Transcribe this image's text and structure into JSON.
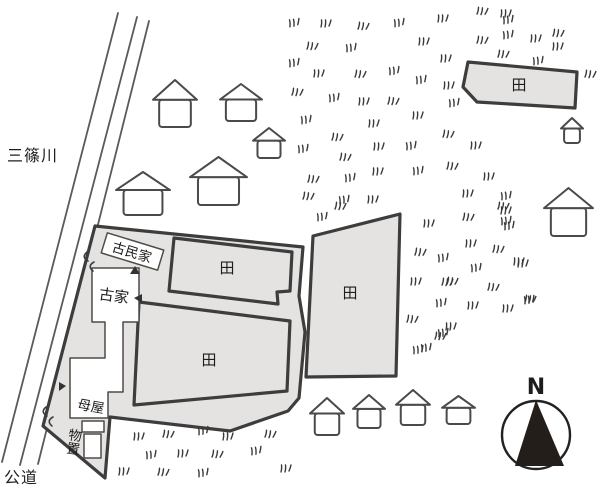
{
  "map": {
    "labels": {
      "river": "三篠川",
      "road": "公道",
      "old_folk_house": "古民家",
      "old_house": "古家",
      "main_house": "母屋",
      "storage": "物置",
      "rice_field": "田",
      "north": "N"
    },
    "colors": {
      "parcel_fill": "#e4e3e2",
      "outline": "#3d3d3d",
      "building_stroke": "#4f4b48",
      "road_line": "#5a5a5a",
      "compass_fill": "#241e1b",
      "text": "#1d1d1d"
    },
    "houses": [
      {
        "x": 153,
        "y": 80,
        "w": 44,
        "h": 47
      },
      {
        "x": 220,
        "y": 84,
        "w": 42,
        "h": 37
      },
      {
        "x": 253,
        "y": 128,
        "w": 32,
        "h": 30
      },
      {
        "x": 190,
        "y": 157,
        "w": 57,
        "h": 48
      },
      {
        "x": 116,
        "y": 172,
        "w": 54,
        "h": 43
      },
      {
        "x": 561,
        "y": 118,
        "w": 22,
        "h": 25
      },
      {
        "x": 544,
        "y": 188,
        "w": 49,
        "h": 48
      },
      {
        "x": 310,
        "y": 398,
        "w": 34,
        "h": 37
      },
      {
        "x": 353,
        "y": 395,
        "w": 32,
        "h": 33
      },
      {
        "x": 396,
        "y": 390,
        "w": 34,
        "h": 35
      },
      {
        "x": 442,
        "y": 396,
        "w": 33,
        "h": 28
      }
    ],
    "grass": [
      [
        288,
        20
      ],
      [
        320,
        20
      ],
      [
        358,
        22
      ],
      [
        393,
        20
      ],
      [
        437,
        15
      ],
      [
        477,
        7
      ],
      [
        502,
        17
      ],
      [
        500,
        10
      ],
      [
        307,
        42
      ],
      [
        345,
        45
      ],
      [
        418,
        38
      ],
      [
        477,
        36
      ],
      [
        502,
        32
      ],
      [
        530,
        35
      ],
      [
        553,
        29
      ],
      [
        288,
        60
      ],
      [
        313,
        70
      ],
      [
        355,
        70
      ],
      [
        388,
        68
      ],
      [
        440,
        55
      ],
      [
        498,
        50
      ],
      [
        532,
        58
      ],
      [
        552,
        43
      ],
      [
        292,
        88
      ],
      [
        328,
        95
      ],
      [
        358,
        98
      ],
      [
        388,
        97
      ],
      [
        415,
        77
      ],
      [
        443,
        82
      ],
      [
        585,
        70
      ],
      [
        300,
        117
      ],
      [
        368,
        120
      ],
      [
        332,
        133
      ],
      [
        448,
        100
      ],
      [
        412,
        112
      ],
      [
        443,
        130
      ],
      [
        297,
        146
      ],
      [
        373,
        143
      ],
      [
        340,
        153
      ],
      [
        405,
        143
      ],
      [
        470,
        142
      ],
      [
        308,
        175
      ],
      [
        344,
        175
      ],
      [
        372,
        168
      ],
      [
        447,
        162
      ],
      [
        412,
        168
      ],
      [
        483,
        173
      ],
      [
        303,
        192
      ],
      [
        338,
        197
      ],
      [
        367,
        196
      ],
      [
        335,
        202
      ],
      [
        316,
        214
      ],
      [
        462,
        190
      ],
      [
        498,
        202
      ],
      [
        500,
        193
      ],
      [
        423,
        220
      ],
      [
        463,
        213
      ],
      [
        503,
        223
      ],
      [
        500,
        207
      ],
      [
        415,
        248
      ],
      [
        437,
        255
      ],
      [
        465,
        240
      ],
      [
        493,
        245
      ],
      [
        500,
        218
      ],
      [
        410,
        278
      ],
      [
        442,
        278
      ],
      [
        470,
        265
      ],
      [
        517,
        260
      ],
      [
        447,
        277
      ],
      [
        435,
        300
      ],
      [
        467,
        302
      ],
      [
        488,
        283
      ],
      [
        523,
        297
      ],
      [
        513,
        258
      ],
      [
        407,
        315
      ],
      [
        437,
        330
      ],
      [
        502,
        305
      ],
      [
        525,
        295
      ],
      [
        412,
        347
      ],
      [
        445,
        323
      ],
      [
        435,
        332
      ],
      [
        420,
        345
      ],
      [
        133,
        433
      ],
      [
        163,
        430
      ],
      [
        197,
        428
      ],
      [
        222,
        433
      ],
      [
        265,
        430
      ],
      [
        145,
        452
      ],
      [
        177,
        450
      ],
      [
        212,
        450
      ],
      [
        250,
        448
      ],
      [
        118,
        468
      ],
      [
        158,
        468
      ],
      [
        197,
        470
      ],
      [
        280,
        465
      ]
    ]
  }
}
